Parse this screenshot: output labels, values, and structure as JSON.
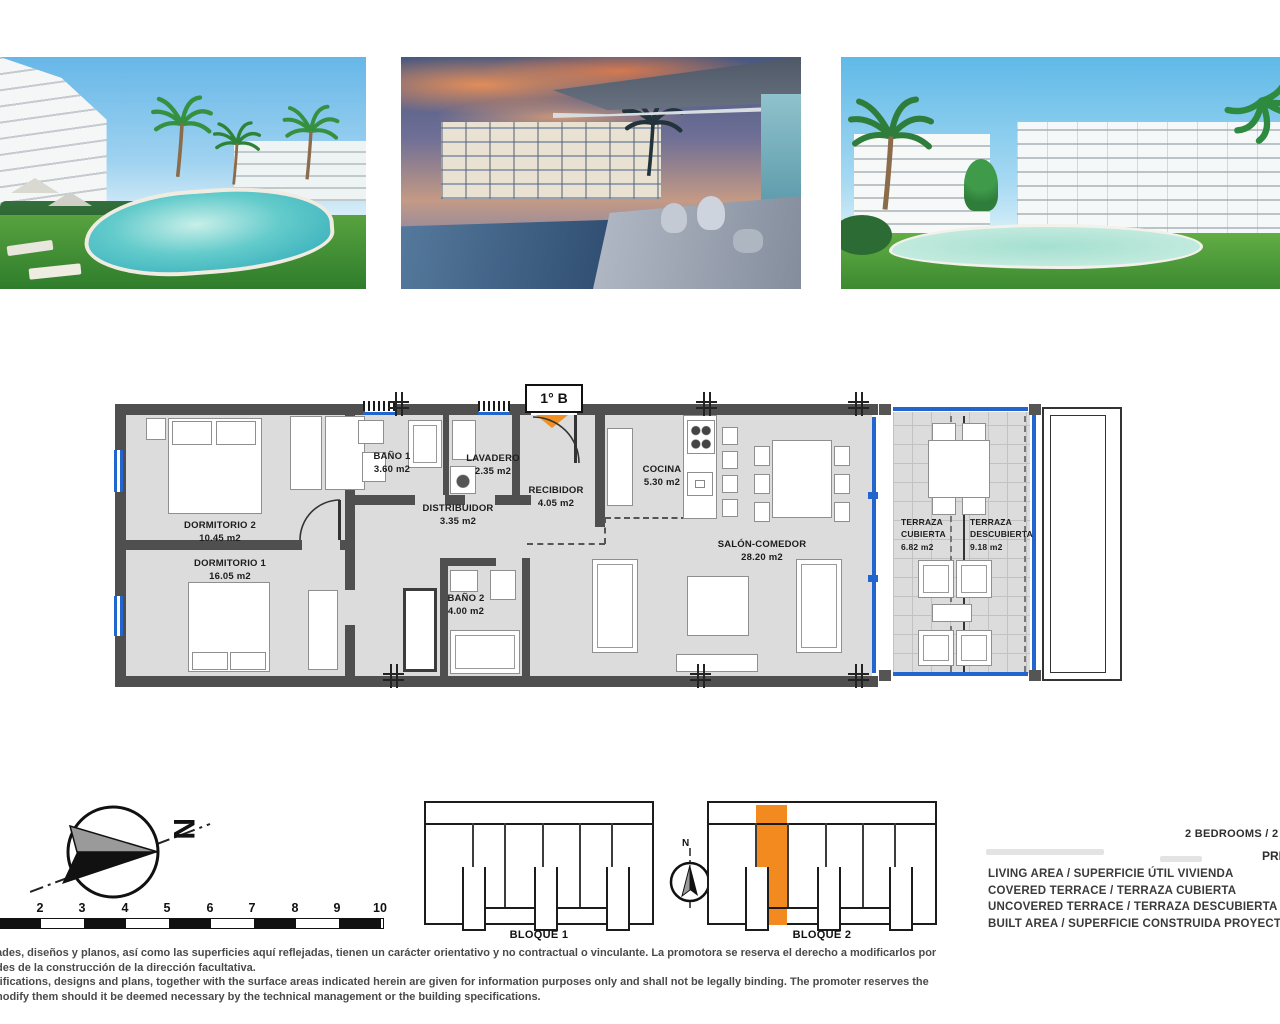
{
  "floor_plan": {
    "unit_label": "1° B",
    "rooms": {
      "dorm2": {
        "name": "DORMITORIO 2",
        "area": "10.45 m2"
      },
      "dorm1": {
        "name": "DORMITORIO 1",
        "area": "16.05 m2"
      },
      "bano1": {
        "name": "BAÑO 1",
        "area": "3.60 m2"
      },
      "lavadero": {
        "name": "LAVADERO",
        "area": "2.35 m2"
      },
      "distribuidor": {
        "name": "DISTRIBUIDOR",
        "area": "3.35 m2"
      },
      "recibidor": {
        "name": "RECIBIDOR",
        "area": "4.05 m2"
      },
      "bano2": {
        "name": "BAÑO 2",
        "area": "4.00 m2"
      },
      "cocina": {
        "name": "COCINA",
        "area": "5.30 m2"
      },
      "salon": {
        "name": "SALÓN-COMEDOR",
        "area": "28.20 m2"
      },
      "terraza_cubierta": {
        "name": "TERRAZA CUBIERTA",
        "area": "6.82 m2"
      },
      "terraza_descubierta": {
        "name": "TERRAZA DESCUBIERTA",
        "area": "9.18 m2"
      }
    }
  },
  "compass": {
    "north_label": "N"
  },
  "scale_bar": {
    "ticks": [
      "2",
      "3",
      "4",
      "5",
      "6",
      "7",
      "8",
      "9",
      "10"
    ]
  },
  "key_plans": {
    "block1_label": "BLOQUE 1",
    "block2_label": "BLOQUE 2",
    "compass_label": "N"
  },
  "summary": {
    "bedrooms_text": "2 BEDROOMS / 2 DO",
    "floor_text": "PRIM",
    "row1": "LIVING AREA / SUPERFICIE ÚTIL VIVIENDA",
    "row2": "COVERED TERRACE / TERRAZA CUBIERTA",
    "row3": "UNCOVERED TERRACE / TERRAZA DESCUBIERTA",
    "row4": "BUILT AREA / SUPERFICIE CONSTRUIDA PROYECTO"
  },
  "disclaimer": {
    "line1": "ades, diseños y planos, así como las superficies aquí reflejadas, tienen un carácter orientativo y no contractual o vinculante. La promotora se reserva el derecho a modificarlos por",
    "line2": "des de la construcción de la dirección facultativa.",
    "line3": "tifications, designs and plans, together with the surface areas indicated herein are given for information purposes only and shall not be legally binding. The promoter reserves the",
    "line4": "nodify them should it be deemed necessary by the technical management or the building specifications."
  },
  "colors": {
    "wall": "#4f4f4f",
    "floor": "#dcdcdc",
    "glazing_blue": "#2265cf",
    "accent_orange": "#f28a20"
  }
}
